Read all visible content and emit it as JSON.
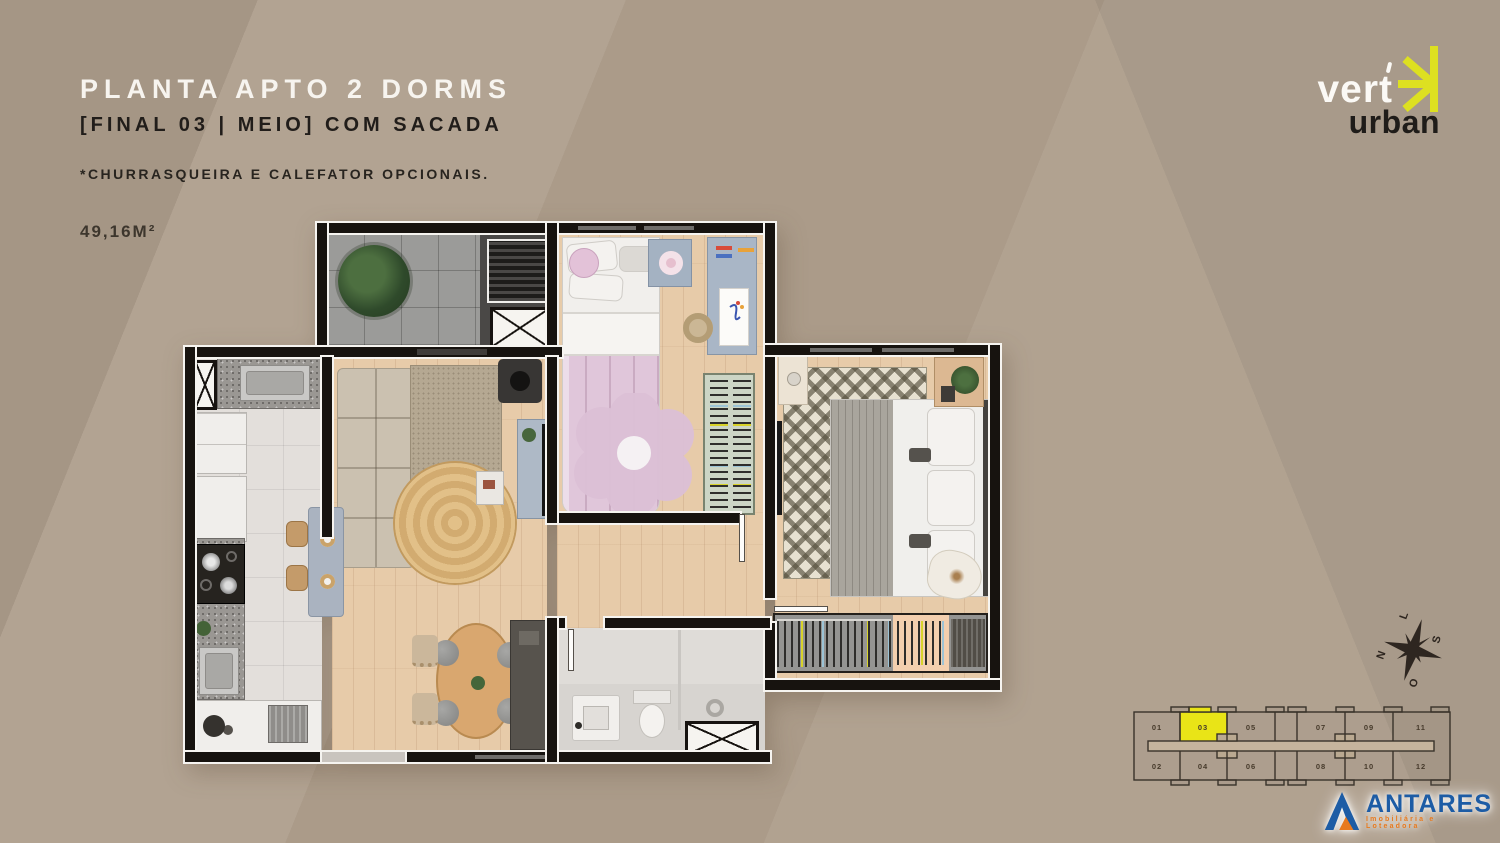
{
  "header": {
    "title": "PLANTA APTO 2 DORMS",
    "subtitle": "[FINAL 03 | MEIO] COM SACADA",
    "note": "*CHURRASQUEIRA E CALEFATOR OPCIONAIS.",
    "area": "49,16M²"
  },
  "brand": {
    "name_top": "vert",
    "name_bottom": "urban",
    "accent_color": "#dde021"
  },
  "developer": {
    "name": "ANTARES",
    "tagline": "Imobiliária e Loteadora",
    "blue_color": "#1d5ca5",
    "orange_color": "#e87a1e"
  },
  "compass": {
    "north": "N",
    "south": "S",
    "east": "L",
    "west": "O"
  },
  "keyplan": {
    "highlighted_unit": "03",
    "highlight_color": "#e9e417",
    "top_units": [
      "01",
      "03",
      "05",
      "07",
      "09",
      "11"
    ],
    "bottom_units": [
      "02",
      "04",
      "06",
      "08",
      "10",
      "12"
    ]
  }
}
